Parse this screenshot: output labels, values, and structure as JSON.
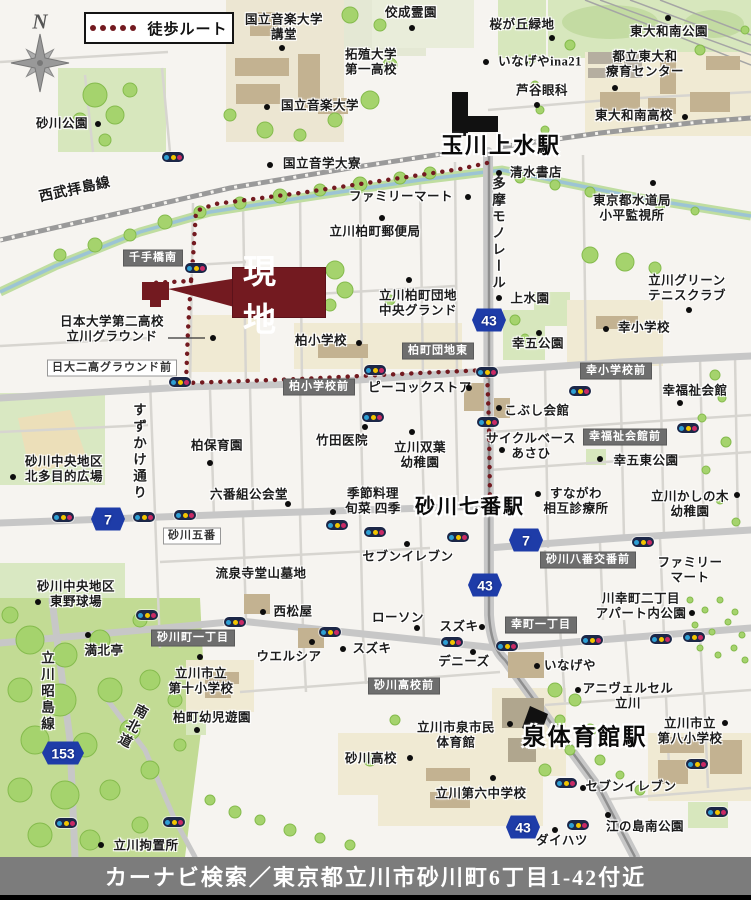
{
  "legend": {
    "route_label": "徒歩ルート"
  },
  "compass": {
    "letter": "N"
  },
  "site": {
    "label": "現地",
    "color": "#731a20"
  },
  "caption": {
    "text": "カーナビ検索／東京都立川市砂川町6丁目1-42付近"
  },
  "colors": {
    "route": "#731a20",
    "shield_blue": "#1e3ca8",
    "caption_bar": "#7c7c7c",
    "park_green": "#d7e7bd",
    "school_cream": "#f0ead3",
    "building_tan": "#c3b291"
  },
  "map": {
    "stations": [
      {
        "t": "玉川上水駅",
        "x": 501,
        "y": 146,
        "s": 22,
        "v": "station",
        "n": "station-label-tamagawajosui"
      },
      {
        "t": "砂川七番駅",
        "x": 470,
        "y": 508,
        "s": 20,
        "v": "station",
        "n": "station-label-sunagawa-nanaban"
      },
      {
        "t": "泉体育館駅",
        "x": 585,
        "y": 737,
        "s": 23,
        "v": "station",
        "n": "station-label-izumi-taiikukan"
      }
    ],
    "road_names": [
      {
        "t": "西武拝島線",
        "x": 75,
        "y": 191,
        "s": 14,
        "r": -12,
        "n": "road-label-seibu-haijima-line"
      },
      {
        "t": "多摩モノレール",
        "x": 497,
        "y": 234,
        "v": "vert",
        "n": "road-label-tama-monorail"
      },
      {
        "t": "すずかけ通り",
        "x": 138,
        "y": 452,
        "v": "vert",
        "n": "road-label-suzukake-dori"
      },
      {
        "t": "立川昭島線",
        "x": 46,
        "y": 692,
        "v": "vert",
        "n": "road-label-tachikawa-akishima-line"
      },
      {
        "t": "南北道",
        "x": 131,
        "y": 726,
        "v": "vert",
        "r": 28,
        "n": "road-label-nanbokudo"
      }
    ],
    "intersections_dark": [
      {
        "t": "千手橋南",
        "x": 153,
        "y": 258
      },
      {
        "t": "柏町団地東",
        "x": 438,
        "y": 351
      },
      {
        "t": "柏小学校前",
        "x": 319,
        "y": 387
      },
      {
        "t": "幸小学校前",
        "x": 616,
        "y": 371
      },
      {
        "t": "幸福祉会館前",
        "x": 625,
        "y": 437
      },
      {
        "t": "砂川八番交番前",
        "x": 588,
        "y": 560
      },
      {
        "t": "砂川高校前",
        "x": 404,
        "y": 686
      },
      {
        "t": "砂川町一丁目",
        "x": 193,
        "y": 638
      },
      {
        "t": "幸町一丁目",
        "x": 541,
        "y": 625
      }
    ],
    "intersections_light": [
      {
        "t": "日大二高グラウンド前",
        "x": 112,
        "y": 368
      },
      {
        "t": "砂川五番",
        "x": 192,
        "y": 536
      }
    ],
    "labels": [
      {
        "t": "砂川公園",
        "x": 62,
        "y": 124
      },
      {
        "t": "国立音楽大学\n講堂",
        "x": 284,
        "y": 27
      },
      {
        "t": "佼成霊園",
        "x": 411,
        "y": 13
      },
      {
        "t": "拓殖大学\n第一高校",
        "x": 371,
        "y": 62
      },
      {
        "t": "桜が丘緑地",
        "x": 522,
        "y": 25
      },
      {
        "t": "東大和南公園",
        "x": 669,
        "y": 32
      },
      {
        "t": "いなげやina21",
        "x": 540,
        "y": 62
      },
      {
        "t": "都立東大和\n療育センター",
        "x": 645,
        "y": 64
      },
      {
        "t": "芦谷眼科",
        "x": 542,
        "y": 91
      },
      {
        "t": "東大和南高校",
        "x": 634,
        "y": 116
      },
      {
        "t": "国立音楽大学",
        "x": 320,
        "y": 106
      },
      {
        "t": "国立音学大寮",
        "x": 322,
        "y": 164
      },
      {
        "t": "ファミリーマート",
        "x": 401,
        "y": 197
      },
      {
        "t": "清水書店",
        "x": 536,
        "y": 173
      },
      {
        "t": "東京都水道局\n小平監視所",
        "x": 632,
        "y": 208
      },
      {
        "t": "立川柏町郵便局",
        "x": 375,
        "y": 232
      },
      {
        "t": "立川グリーン\nテニスクラブ",
        "x": 687,
        "y": 288
      },
      {
        "t": "上水園",
        "x": 530,
        "y": 299
      },
      {
        "t": "幸小学校",
        "x": 644,
        "y": 328
      },
      {
        "t": "幸五公園",
        "x": 538,
        "y": 344
      },
      {
        "t": "立川柏町団地\n中央グランド",
        "x": 418,
        "y": 303
      },
      {
        "t": "日本大学第二高校\n立川グラウンド",
        "x": 112,
        "y": 329
      },
      {
        "t": "柏小学校",
        "x": 321,
        "y": 341
      },
      {
        "t": "ピーコックストア",
        "x": 420,
        "y": 388
      },
      {
        "t": "竹田医院",
        "x": 342,
        "y": 441
      },
      {
        "t": "立川双葉\n幼稚園",
        "x": 420,
        "y": 455
      },
      {
        "t": "柏保育園",
        "x": 217,
        "y": 446
      },
      {
        "t": "砂川中央地区\n北多目的広場",
        "x": 64,
        "y": 469
      },
      {
        "t": "六番組公会堂",
        "x": 249,
        "y": 495
      },
      {
        "t": "季節料理\n旬菜 四季",
        "x": 373,
        "y": 501
      },
      {
        "t": "セブンイレブン",
        "x": 408,
        "y": 557
      },
      {
        "t": "こぶし会館",
        "x": 537,
        "y": 411
      },
      {
        "t": "サイクルベース\nあさひ",
        "x": 531,
        "y": 446
      },
      {
        "t": "幸福祉会館",
        "x": 695,
        "y": 391
      },
      {
        "t": "幸五東公園",
        "x": 646,
        "y": 461
      },
      {
        "t": "すながわ\n相互診療所",
        "x": 576,
        "y": 501
      },
      {
        "t": "立川かしの木\n幼稚園",
        "x": 690,
        "y": 504
      },
      {
        "t": "ファミリー\nマート",
        "x": 690,
        "y": 570
      },
      {
        "t": "流泉寺堂山墓地",
        "x": 261,
        "y": 574
      },
      {
        "t": "西松屋",
        "x": 293,
        "y": 612
      },
      {
        "t": "ローソン",
        "x": 398,
        "y": 618
      },
      {
        "t": "スズキ",
        "x": 459,
        "y": 627
      },
      {
        "t": "スズキ",
        "x": 372,
        "y": 649
      },
      {
        "t": "ウエルシア",
        "x": 289,
        "y": 657
      },
      {
        "t": "デニーズ",
        "x": 464,
        "y": 662
      },
      {
        "t": "川幸町二丁目\nアパート内公園",
        "x": 641,
        "y": 606
      },
      {
        "t": "いなげや",
        "x": 570,
        "y": 666
      },
      {
        "t": "アニヴェルセル\n立川",
        "x": 628,
        "y": 696
      },
      {
        "t": "立川市立\n第八小学校",
        "x": 690,
        "y": 731
      },
      {
        "t": "立川市泉市民\n体育館",
        "x": 456,
        "y": 735
      },
      {
        "t": "砂川高校",
        "x": 371,
        "y": 759
      },
      {
        "t": "砂川中央地区\n東野球場",
        "x": 76,
        "y": 594
      },
      {
        "t": "満北亭",
        "x": 104,
        "y": 651
      },
      {
        "t": "立川市立\n第十小学校",
        "x": 201,
        "y": 681
      },
      {
        "t": "柏町幼児遊園",
        "x": 212,
        "y": 718
      },
      {
        "t": "立川第六中学校",
        "x": 481,
        "y": 794
      },
      {
        "t": "セブンイレブン",
        "x": 631,
        "y": 787
      },
      {
        "t": "ダイハツ",
        "x": 562,
        "y": 841
      },
      {
        "t": "江の島南公園",
        "x": 645,
        "y": 827
      },
      {
        "t": "立川拘置所",
        "x": 146,
        "y": 846
      }
    ],
    "shields": [
      {
        "num": "43",
        "x": 489,
        "y": 320
      },
      {
        "num": "43",
        "x": 485,
        "y": 585
      },
      {
        "num": "43",
        "x": 523,
        "y": 827
      },
      {
        "num": "7",
        "x": 108,
        "y": 519
      },
      {
        "num": "7",
        "x": 526,
        "y": 540
      },
      {
        "num": "153",
        "x": 63,
        "y": 753
      }
    ],
    "signals": [
      [
        173,
        157
      ],
      [
        196,
        268
      ],
      [
        180,
        382
      ],
      [
        375,
        370
      ],
      [
        487,
        372
      ],
      [
        373,
        417
      ],
      [
        488,
        422
      ],
      [
        337,
        525
      ],
      [
        375,
        532
      ],
      [
        458,
        537
      ],
      [
        63,
        517
      ],
      [
        144,
        517
      ],
      [
        185,
        515
      ],
      [
        580,
        391
      ],
      [
        688,
        428
      ],
      [
        643,
        542
      ],
      [
        147,
        615
      ],
      [
        235,
        622
      ],
      [
        330,
        632
      ],
      [
        452,
        642
      ],
      [
        507,
        646
      ],
      [
        592,
        640
      ],
      [
        661,
        639
      ],
      [
        694,
        637
      ],
      [
        66,
        823
      ],
      [
        174,
        822
      ],
      [
        566,
        783
      ],
      [
        578,
        825
      ],
      [
        717,
        812
      ],
      [
        697,
        764
      ]
    ],
    "poi_dots": [
      [
        98,
        124
      ],
      [
        282,
        48
      ],
      [
        267,
        107
      ],
      [
        270,
        165
      ],
      [
        412,
        28
      ],
      [
        552,
        38
      ],
      [
        668,
        18
      ],
      [
        486,
        62
      ],
      [
        615,
        88
      ],
      [
        537,
        105
      ],
      [
        685,
        117
      ],
      [
        468,
        197
      ],
      [
        499,
        173
      ],
      [
        653,
        183
      ],
      [
        382,
        218
      ],
      [
        689,
        310
      ],
      [
        499,
        298
      ],
      [
        606,
        329
      ],
      [
        539,
        333
      ],
      [
        409,
        280
      ],
      [
        213,
        338
      ],
      [
        359,
        343
      ],
      [
        210,
        463
      ],
      [
        13,
        477
      ],
      [
        288,
        504
      ],
      [
        365,
        427
      ],
      [
        412,
        432
      ],
      [
        469,
        388
      ],
      [
        333,
        512
      ],
      [
        407,
        544
      ],
      [
        499,
        408
      ],
      [
        502,
        450
      ],
      [
        680,
        403
      ],
      [
        600,
        459
      ],
      [
        538,
        494
      ],
      [
        737,
        495
      ],
      [
        263,
        612
      ],
      [
        417,
        628
      ],
      [
        482,
        627
      ],
      [
        343,
        649
      ],
      [
        312,
        642
      ],
      [
        473,
        652
      ],
      [
        510,
        724
      ],
      [
        410,
        758
      ],
      [
        692,
        613
      ],
      [
        537,
        666
      ],
      [
        578,
        690
      ],
      [
        725,
        723
      ],
      [
        583,
        788
      ],
      [
        493,
        778
      ],
      [
        555,
        830
      ],
      [
        608,
        815
      ],
      [
        101,
        845
      ],
      [
        88,
        635
      ],
      [
        38,
        602
      ],
      [
        200,
        657
      ],
      [
        197,
        730
      ]
    ]
  }
}
